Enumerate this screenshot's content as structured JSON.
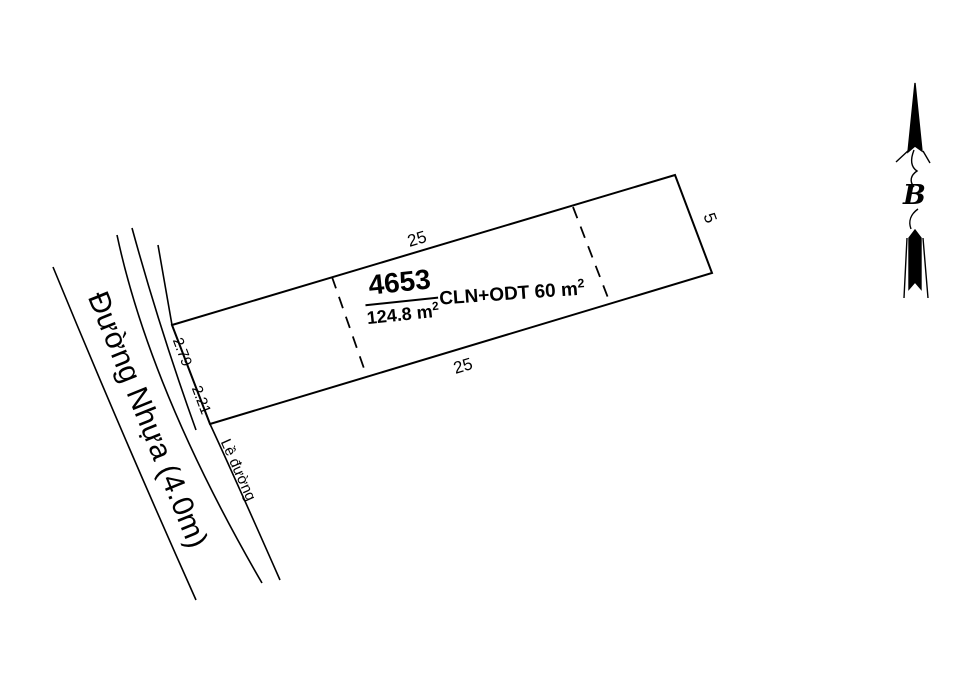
{
  "parcel": {
    "number": "4653",
    "area_value": "124.8 m",
    "area_sup": "2",
    "land_use_value": "CLN+ODT 60 m",
    "land_use_sup": "2",
    "dim_top": "25",
    "dim_bottom": "25",
    "dim_right": "5",
    "dim_left_upper": "2.79",
    "dim_left_lower": "2.21"
  },
  "road": {
    "name": "Đường Nhựa (4.0m)",
    "shoulder_label": "Lề đường"
  },
  "north_arrow": {
    "letter": "B"
  },
  "colors": {
    "ink": "#000000",
    "background": "#ffffff"
  }
}
